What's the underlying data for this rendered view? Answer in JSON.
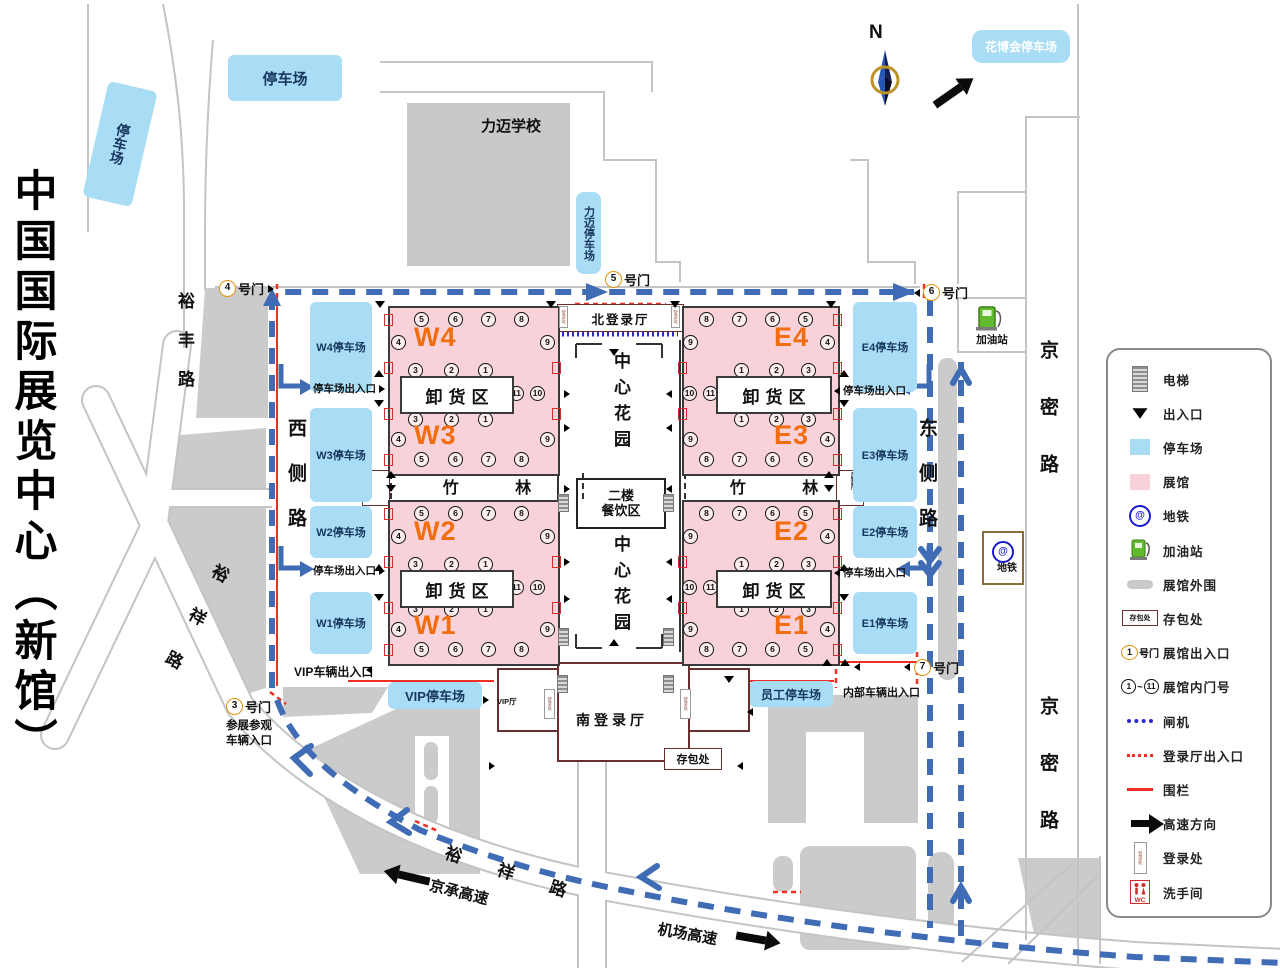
{
  "title": "中国国际展览中心（新馆）",
  "compass_label": "N",
  "school_label": "力迈学校",
  "gates": [
    {
      "num": "3",
      "suffix": "号门",
      "note_lines": [
        "参展参观",
        "车辆入口"
      ]
    },
    {
      "num": "4",
      "suffix": "号门"
    },
    {
      "num": "5",
      "suffix": "号门"
    },
    {
      "num": "6",
      "suffix": "号门"
    },
    {
      "num": "7",
      "suffix": "号门"
    }
  ],
  "roads": {
    "yufeng": "裕丰路",
    "xice": "西侧路",
    "yuxiang_left": "裕祥路",
    "yuxiang_bottom": "裕祥路",
    "dongce": "东侧路",
    "jingmi_top": "京密路",
    "jingmi_bottom": "京密路",
    "jingcheng": "京承高速",
    "jichang": "机场高速"
  },
  "parkings": {
    "far_left": "停车场",
    "top": "停车场",
    "limai": "力迈停车场",
    "huabohui": "花博会停车场",
    "west": [
      "W4停车场",
      "W3停车场",
      "W2停车场",
      "W1停车场"
    ],
    "east": [
      "E4停车场",
      "E3停车场",
      "E2停车场",
      "E1停车场"
    ],
    "vip": "VIP停车场",
    "staff": "员工停车场"
  },
  "halls": {
    "west": [
      "W4",
      "W3",
      "W2",
      "W1"
    ],
    "east": [
      "E4",
      "E3",
      "E2",
      "E1"
    ]
  },
  "doors": {
    "outer_row": [
      "5",
      "6",
      "7",
      "8"
    ],
    "inner_row": [
      "3",
      "2",
      "1"
    ],
    "outer_side": "4",
    "inner_side": "9",
    "dock_pair": [
      "11",
      "10"
    ]
  },
  "areas": {
    "dock": "卸货区",
    "bamboo": "竹 林",
    "north_lobby": "北登录厅",
    "south_lobby": "南登录厅",
    "west_lobby": "西登录厅",
    "east_lobby": "东登录厅",
    "garden": "中心花园",
    "dining_lines": [
      "二楼",
      "餐饮区"
    ],
    "bag": "存包处",
    "vip_room": "VIP厅",
    "reg_desk": "登录处"
  },
  "poi": {
    "gas": "加油站",
    "metro": "地铁"
  },
  "entrances": {
    "parking_gate": "停车场出入口",
    "vip_gate": "VIP车辆出入口",
    "internal_gate": "内部车辆出入口"
  },
  "legend": {
    "items": [
      {
        "icon": "elevator",
        "label": "电梯"
      },
      {
        "icon": "triangle",
        "label": "出入口"
      },
      {
        "icon": "parking",
        "label": "停车场"
      },
      {
        "icon": "hall",
        "label": "展馆"
      },
      {
        "icon": "metro",
        "label": "地铁"
      },
      {
        "icon": "gas",
        "label": "加油站"
      },
      {
        "icon": "perimeter",
        "label": "展馆外围"
      },
      {
        "icon": "bag",
        "label": "存包处",
        "icon_text": "存包处"
      },
      {
        "icon": "gate",
        "label": "展馆出入口",
        "icon_num": "1",
        "icon_text": "号门"
      },
      {
        "icon": "range",
        "label": "展馆内门号",
        "icon_nums": [
          "1",
          "11"
        ],
        "icon_sep": "~"
      },
      {
        "icon": "turnstile",
        "label": "闸机"
      },
      {
        "icon": "lobby-door",
        "label": "登录厅出入口"
      },
      {
        "icon": "fence",
        "label": "围栏"
      },
      {
        "icon": "highway",
        "label": "高速方向"
      },
      {
        "icon": "regdesk",
        "label": "登录处",
        "icon_text": "登录处"
      },
      {
        "icon": "wc",
        "label": "洗手间",
        "icon_text": "WC"
      }
    ]
  },
  "colors": {
    "parking": "#a9dcf5",
    "hall": "#f8d2d8",
    "route": "#3f6cb5",
    "fence": "#ef2f24",
    "hall_label": "#f26d0d",
    "turnstile": "#2a2ad0"
  }
}
